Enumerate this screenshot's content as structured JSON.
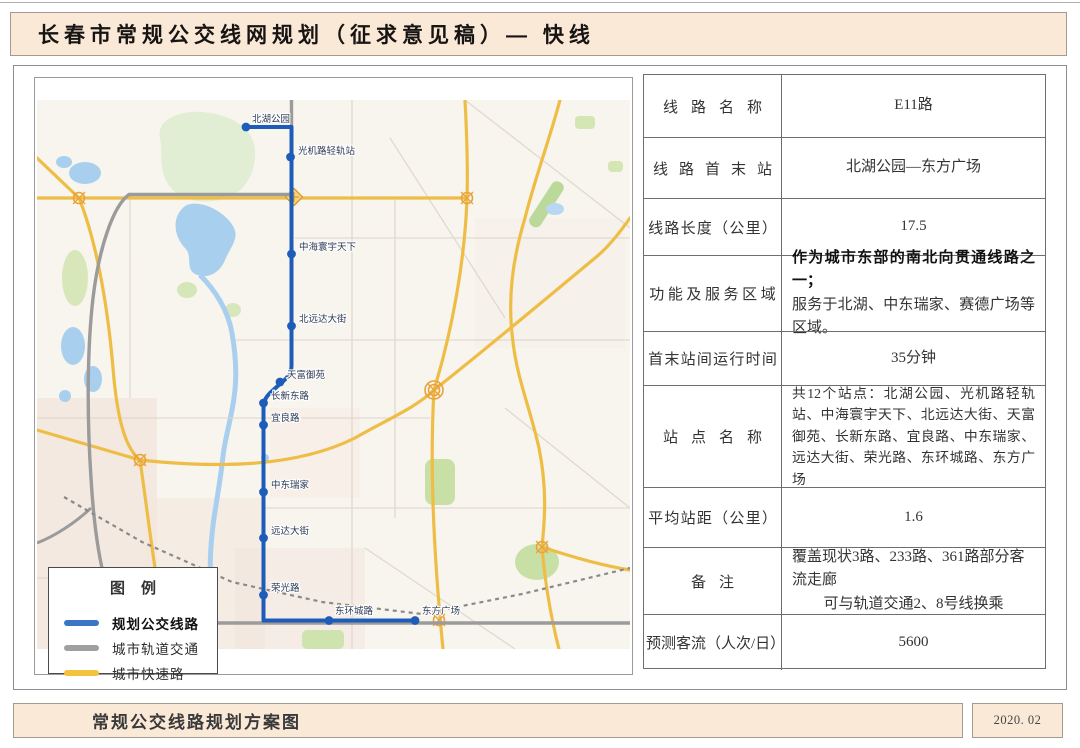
{
  "header": {
    "title": "长春市常规公交线网规划（征求意见稿）— 快线"
  },
  "map": {
    "route_color": "#1d5cb8",
    "legend": {
      "title": "图例",
      "items": [
        {
          "name": "planned-bus-route",
          "label": "规划公交线路",
          "color": "#3b76c4"
        },
        {
          "name": "urban-rail",
          "label": "城市轨道交通",
          "color": "#a0a0a0"
        },
        {
          "name": "urban-expressway",
          "label": "城市快速路",
          "color": "#f2c43c"
        }
      ]
    },
    "stations": [
      {
        "name": "北湖公园",
        "x": 211,
        "y": 49,
        "lx": 217,
        "ly": 44
      },
      {
        "name": "光机路轻轨站",
        "x": 255.5,
        "y": 79,
        "lx": 263,
        "ly": 76
      },
      {
        "name": "中海寰宇天下",
        "x": 256.5,
        "y": 176,
        "lx": 264,
        "ly": 172
      },
      {
        "name": "北远达大街",
        "x": 256.5,
        "y": 248,
        "lx": 264,
        "ly": 244
      },
      {
        "name": "天富御苑",
        "x": 245,
        "y": 304,
        "lx": 252,
        "ly": 300
      },
      {
        "name": "长新东路",
        "x": 228.5,
        "y": 325,
        "lx": 236,
        "ly": 321
      },
      {
        "name": "宜良路",
        "x": 228.5,
        "y": 347,
        "lx": 236,
        "ly": 343
      },
      {
        "name": "中东瑞家",
        "x": 228.5,
        "y": 414,
        "lx": 236,
        "ly": 410
      },
      {
        "name": "远达大街",
        "x": 228.5,
        "y": 460,
        "lx": 236,
        "ly": 456
      },
      {
        "name": "荣光路",
        "x": 228.5,
        "y": 517,
        "lx": 236,
        "ly": 513
      },
      {
        "name": "东环城路",
        "x": 294,
        "y": 542.5,
        "lx": 300,
        "ly": 536
      },
      {
        "name": "东方广场",
        "x": 380,
        "y": 542.5,
        "lx": 387,
        "ly": 536
      }
    ]
  },
  "table": {
    "rows": [
      {
        "label": "线路名称",
        "value": "E11路"
      },
      {
        "label": "线路首末站",
        "value": "北湖公园—东方广场"
      },
      {
        "label": "线路长度（公里）",
        "value": "17.5"
      },
      {
        "label": "功能及服务区域",
        "lines": [
          "作为城市东部的南北向贯通线路之一；",
          "服务于北湖、中东瑞家、赛德广场等区域。"
        ]
      },
      {
        "label": "首末站间运行时间",
        "value": "35分钟"
      },
      {
        "label": "站点名称",
        "value": "共12个站点：北湖公园、光机路轻轨站、中海寰宇天下、北远达大街、天富御苑、长新东路、宜良路、中东瑞家、远达大街、荣光路、东环城路、东方广场"
      },
      {
        "label": "平均站距（公里）",
        "value": "1.6"
      },
      {
        "label": "备注",
        "lines": [
          "覆盖现状3路、233路、361路部分客流走廊",
          "可与轨道交通2、8号线换乘"
        ]
      },
      {
        "label": "预测客流（人次/日）",
        "value": "5600"
      }
    ]
  },
  "footer": {
    "left": "常规公交线路规划方案图",
    "right": "2020. 02"
  }
}
